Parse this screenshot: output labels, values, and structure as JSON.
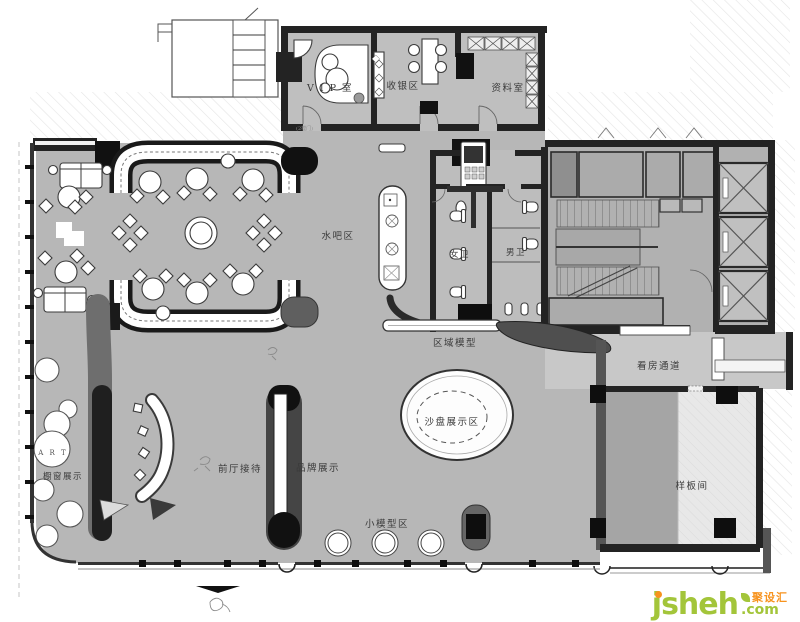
{
  "plan": {
    "labels": {
      "vip": "V I P 室",
      "cashier": "收银区",
      "archive": "资料室",
      "water_bar": "水吧区",
      "womens_wc": "女卫",
      "mens_wc": "男卫",
      "area_model": "区域模型",
      "viewing_corridor": "看房通道",
      "sample_room": "样板间",
      "sand_table": "沙盘展示区",
      "reception": "前厅接待",
      "brand_display": "品牌展示",
      "window_display": "橱窗展示",
      "small_model": "小模型区",
      "art": "A R T",
      "door_note": "(2樘门)"
    },
    "colors": {
      "floor": "#b7b7b7",
      "wall": "#232323",
      "corridor": "#c8c8c8",
      "sample_room_light": "#e8e8e8"
    }
  },
  "watermark": {
    "name": "jsheh",
    "tld": ".com",
    "badge": "聚设汇",
    "green": "#a3c53a",
    "orange": "#f7931e"
  }
}
